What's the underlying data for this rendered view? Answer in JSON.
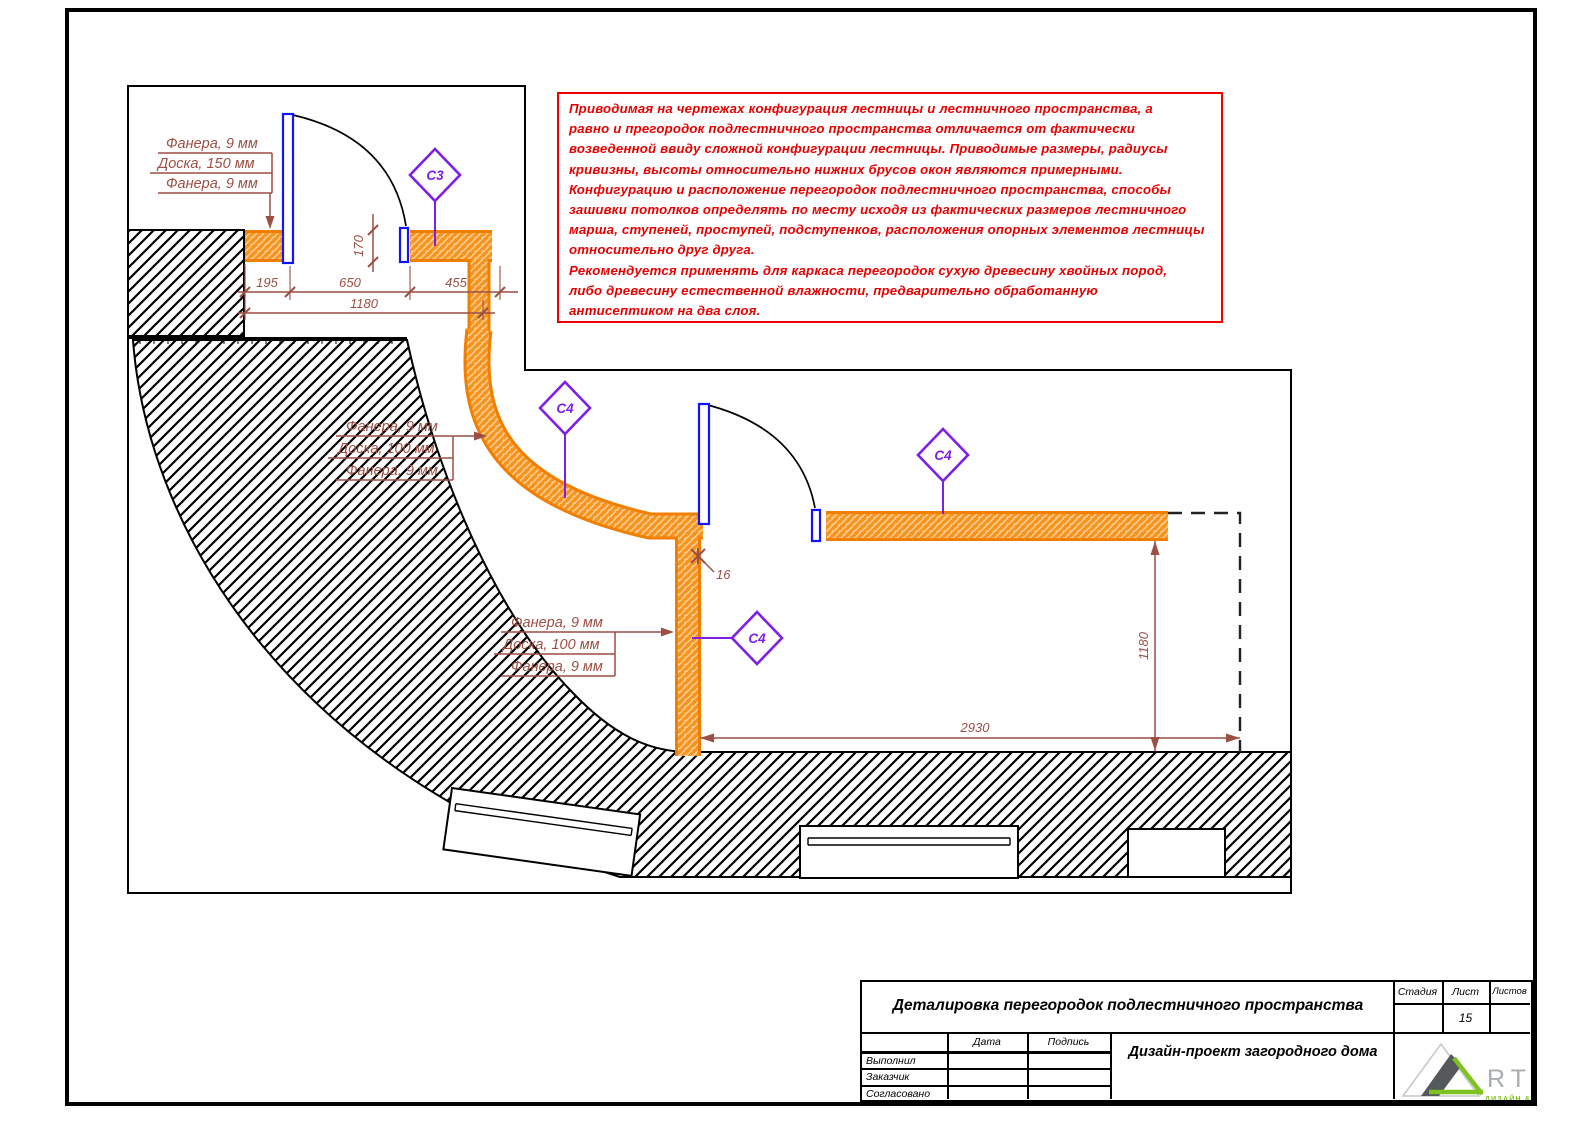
{
  "note_box": {
    "border_color": "#F00000",
    "lines": [
      "Приводимая на чертежах конфигурация лестницы и лестничного пространства, а",
      "равно и прегородок подлестничного пространства отличается от фактически",
      "возведенной ввиду сложной конфигурации лестницы. Приводимые размеры, радиусы",
      "кривизны, высоты относительно нижних брусов окон являются примерными.",
      "Конфигурацию и расположение перегородок подлестничного пространства, способы",
      "зашивки потолков определять по месту исходя из фактических размеров лестничного",
      "марша, ступеней, проступей, подступенков, расположения опорных элементов лестницы",
      "относительно друг друга.",
      "Рекомендуется применять для каркаса перегородок сухую древесину хвойных пород,",
      "либо древесину естественной влажности, предварительно обработанную",
      "антисептиком на два слоя."
    ]
  },
  "drawing": {
    "labels": {
      "top": [
        "Фанера, 9 мм",
        "Доска, 150 мм",
        "Фанера, 9 мм"
      ],
      "middle": [
        "Фанера, 9 мм",
        "Доска, 100 мм",
        "Фанера, 9 мм"
      ],
      "lower": [
        "Фанера, 9 мм",
        "Доска, 100 мм",
        "Фанера, 9 мм"
      ]
    },
    "dimensions": {
      "seg1": "195",
      "seg2": "650",
      "seg3": "455",
      "total": "1180",
      "door_offset": "170",
      "gap": "16",
      "room_width": "2930",
      "room_height": "1180"
    },
    "markers": {
      "c3": "C3",
      "c4": "C4"
    },
    "colors": {
      "partition_orange": "#F68B1F",
      "marker_purple": "#7D1FE8",
      "door_blue": "#1313FF",
      "dimension_brown": "#9C4F44",
      "note_red": "#F00000"
    }
  },
  "title_block": {
    "title": "Деталировка перегородок подлестничного пространства",
    "project": "Дизайн-проект загородного дома",
    "columns": {
      "stage": "Стадия",
      "sheet": "Лист",
      "sheets": "Листов"
    },
    "sheet_number": "15",
    "table": {
      "date": "Дата",
      "signature": "Подпись",
      "rows": [
        "Выполнил",
        "Заказчик",
        "Согласовано"
      ]
    },
    "logo": {
      "letters": "RTEL",
      "tagline": "ДИЗАЙН & ДЕКОР"
    }
  }
}
